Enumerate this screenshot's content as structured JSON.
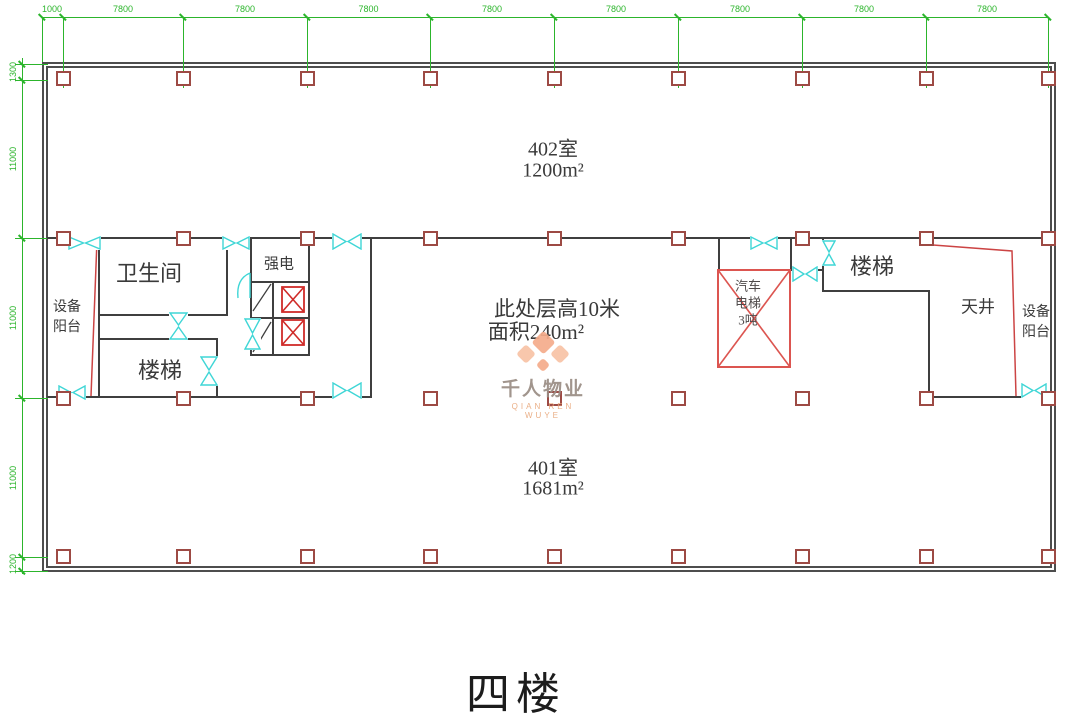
{
  "floor_title": "四楼",
  "dims": {
    "top_offset_label": "1000",
    "top_bay_labels": [
      "7800",
      "7800",
      "7800",
      "7800",
      "7800",
      "7800",
      "7800",
      "7800"
    ],
    "left_labels": [
      "1300",
      "11000",
      "11000",
      "11000",
      "1200"
    ]
  },
  "rooms": {
    "room_402": {
      "name": "402室",
      "area": "1200m²"
    },
    "room_401": {
      "name": "401室",
      "area": "1681m²"
    },
    "center_note": {
      "line1": "此处层高10米",
      "line2": "面积240m²"
    },
    "toilet": {
      "name": "卫生间"
    },
    "stairs_left": {
      "name": "楼梯"
    },
    "stairs_right": {
      "name": "楼梯"
    },
    "strong_power": {
      "name": "强电"
    },
    "equip_balcony_left": {
      "line1": "设备",
      "line2": "阳台"
    },
    "equip_balcony_right": {
      "line1": "设备",
      "line2": "阳台"
    },
    "courtyard": {
      "name": "天井"
    },
    "car_elevator": {
      "line1": "汽车",
      "line2": "电梯",
      "line3": "3吨"
    }
  },
  "watermark": {
    "logo": "flower-icon",
    "name": "千人物业",
    "sub": "QIAN REN WUYE"
  },
  "colors": {
    "dimension_green": "#2cb52c",
    "wall_dark": "#3f3f3f",
    "column_red": "#9d4a44",
    "shaft_red": "#cf2b28",
    "elevator_red": "#dc5550",
    "door_cyan": "#3fd6d6",
    "watermark_orange": "#f5ac8b",
    "text_dark": "#3a3a3a"
  }
}
